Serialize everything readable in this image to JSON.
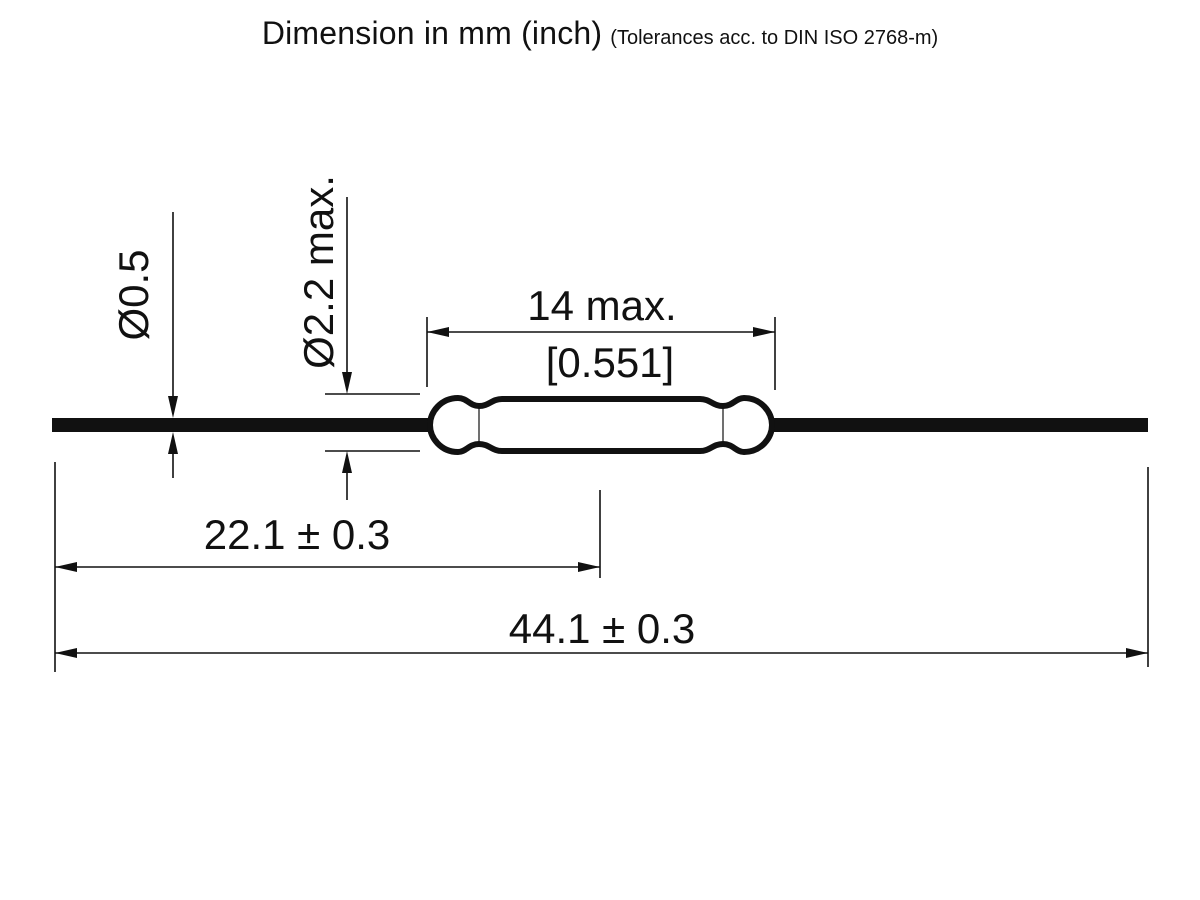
{
  "title": {
    "main": "Dimension in mm (inch)",
    "tolerance_note": "(Tolerances acc. to DIN ISO 2768-m)"
  },
  "dimensions": {
    "lead_diameter": "Ø0.5",
    "glass_diameter": "Ø2.2 max.",
    "glass_length_mm": "14 max.",
    "glass_length_inch": "[0.551]",
    "lead_tip_to_glass_center": "22.1 ± 0.3",
    "overall_length": "44.1 ± 0.3"
  },
  "colors": {
    "ink": "#111111",
    "background": "#ffffff"
  }
}
